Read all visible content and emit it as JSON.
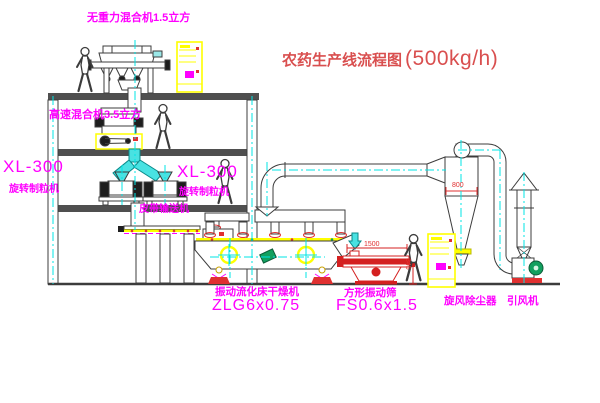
{
  "title": {
    "text": "农药生产线流程图",
    "capacity": "(500kg/h)"
  },
  "equipment_labels": {
    "gravity_mixer": "无重力混合机1.5立方",
    "high_speed_mixer": "高速混合机3.5立方",
    "granulator_left_model": "XL-300",
    "granulator_left_name": "旋转制粒机",
    "granulator_mid_model": "XL-300",
    "granulator_mid_name": "旋转制粒机",
    "belt_conveyor": "皮带输送机",
    "dryer_name": "振动流化床干燥机",
    "dryer_model": "ZLG6x0.75",
    "screen_name": "方形振动筛",
    "screen_model": "FS0.6x1.5",
    "cyclone_name": "旋风除尘器",
    "fan_name": "引风机"
  },
  "dimensions": {
    "screen_length": "1500",
    "screen_height": "345",
    "cyclone_dim": "800"
  },
  "colors": {
    "label_magenta": "#FF00FF",
    "title_red": "#D94F4F",
    "dim_red": "#E03030",
    "centerline_cyan": "#00E5E5",
    "equipment_yellow": "#FFFF00",
    "motor_green": "#12A05F"
  }
}
